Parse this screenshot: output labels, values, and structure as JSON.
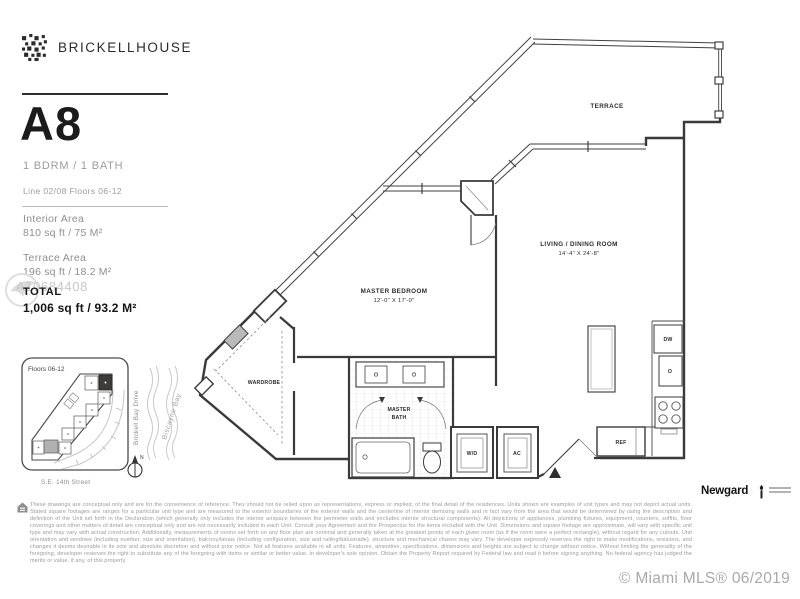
{
  "header": {
    "brand": "BRICKELLHOUSE"
  },
  "unit": {
    "name": "A8",
    "config": "1 BDRM / 1 BATH",
    "line_floors": "Line 02/08  Floors 06-12",
    "interior_label": "Interior Area",
    "interior_value": "810 sq ft / 75 M²",
    "terrace_label": "Terrace Area",
    "terrace_value": "196 sq ft / 18.2 M²",
    "total_label": "TOTAL",
    "total_value": "1,006 sq ft / 93.2 M²"
  },
  "watermark": {
    "mls_number": "A10684408"
  },
  "floor_plan": {
    "terrace": "TERRACE",
    "living": "LIVING / DINING ROOM",
    "living_dims": "14'-4\" X 24'-8\"",
    "master": "MASTER BEDROOM",
    "master_dims": "12'-0\" X 17'-0\"",
    "wardrobe": "WARDROBE",
    "bath_line1": "MASTER",
    "bath_line2": "BATH",
    "washer_dryer": "W/D",
    "ac": "AC",
    "refrigerator": "REF",
    "dishwasher": "DW",
    "oven": "O"
  },
  "site_map": {
    "floors": "Floors 06-12",
    "street_right": "Brickell Bay Drive",
    "bay": "Biscayne Bay",
    "street_bottom": "S.E. 14th Street",
    "compass": "N"
  },
  "footer": {
    "disclaimer": "These drawings are conceptual only and are for the convenience of reference. They should not be relied upon as representations, express or implied, of the final detail of the residences. Units shown are examples of unit types and may not depict actual units. Stated square footages are ranges for a particular unit type and are measured to the exterior boundaries of the exterior walls and the centerline of interior demising walls and in fact vary from the area that would be determined by using the description and definition of the Unit set forth in the Declaration (which generally only includes the interior airspace between the perimeter walls and excludes interior structural components). All depictions of appliances, plumbing fixtures, equipment, counters, soffits, floor coverings and other matters of detail are conceptual only and are not necessarily included in each Unit. Consult your Agreement and the Prospectus for the items included with the Unit. Dimensions and square footage are approximate, will vary with specific unit type and may vary with actual construction. Additionally, measurements of rooms set forth on any floor plan are nominal and generally taken at the greatest points of each given room (as if the room were a perfect rectangle), without regard for any cutouts. Unit orientation and windows (including number, size and orientation), balcony/lanais (including configuration, size and railing/balustrade), structure and mechanical chases may vary. The developer expressly reserves the right to make modifications, revisions, and changes it deems desirable in its sole and absolute discretion and without prior notice. Not all features available in all units. Features, amenities, specifications, dimensions and heights are subject to change without notice. Without limiting the generality of the foregoing, developer reserves the right to substitute any of the foregoing with items or similar or better value, in developer's sole opinion. Obtain the Property Report required by Federal law and read it before signing anything. No federal agency has judged the merits or value, if any, of this property.",
    "developer": "Newgard",
    "mls_credit": "© Miami MLS® 06/2019"
  },
  "colors": {
    "ink": "#3a3a3a",
    "muted": "#9c9c9c",
    "watermark": "#c7c7c7"
  }
}
